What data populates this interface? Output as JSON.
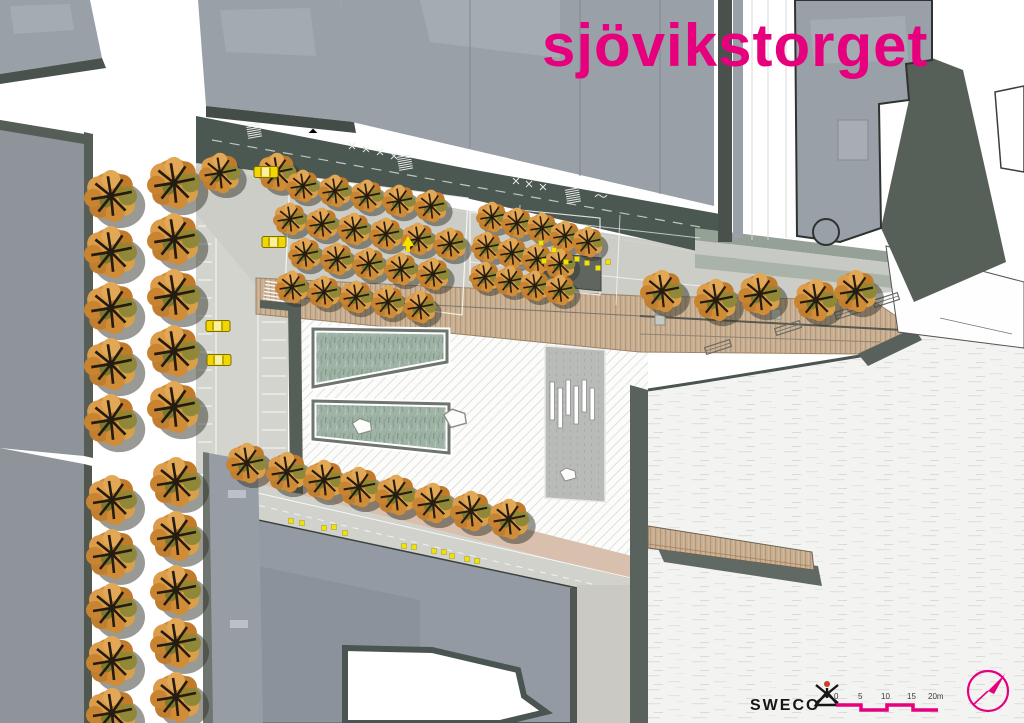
{
  "title": "sjövikstorget",
  "colors": {
    "accent": "#e6007e",
    "building": "#9aa0a8",
    "building_dark_edge": "#4a524c",
    "road_dark": "#4b5751",
    "street_light": "#d4d4ce",
    "wood": "#c8ae91",
    "pool_green": "#9eb2a5",
    "water": "#f3f3f1",
    "tree_orange": "#cf8a3a",
    "car_yellow": "#f2d600"
  },
  "footer": {
    "logo_text": "SWECO",
    "scale_labels": [
      "0",
      "5",
      "10",
      "15",
      "20m"
    ]
  },
  "map": {
    "trees": [
      [
        111,
        196,
        27
      ],
      [
        111,
        252,
        27
      ],
      [
        111,
        308,
        27
      ],
      [
        111,
        364,
        27
      ],
      [
        111,
        420,
        27
      ],
      [
        174,
        183,
        27
      ],
      [
        174,
        239,
        27
      ],
      [
        174,
        295,
        27
      ],
      [
        174,
        351,
        27
      ],
      [
        174,
        407,
        27
      ],
      [
        220,
        173,
        21
      ],
      [
        277,
        172,
        20
      ],
      [
        112,
        500,
        26
      ],
      [
        112,
        554,
        26
      ],
      [
        112,
        608,
        26
      ],
      [
        112,
        661,
        26
      ],
      [
        112,
        713,
        26
      ],
      [
        176,
        482,
        26
      ],
      [
        176,
        536,
        26
      ],
      [
        176,
        590,
        26
      ],
      [
        176,
        643,
        26
      ],
      [
        176,
        697,
        26
      ],
      [
        303,
        186,
        17
      ],
      [
        335,
        191,
        17
      ],
      [
        367,
        196,
        17
      ],
      [
        399,
        201,
        17
      ],
      [
        431,
        206,
        17
      ],
      [
        290,
        219,
        17
      ],
      [
        322,
        224,
        17
      ],
      [
        354,
        229,
        17
      ],
      [
        386,
        234,
        17
      ],
      [
        418,
        239,
        17
      ],
      [
        450,
        244,
        17
      ],
      [
        305,
        254,
        17
      ],
      [
        337,
        259,
        17
      ],
      [
        369,
        264,
        17
      ],
      [
        401,
        269,
        17
      ],
      [
        433,
        274,
        17
      ],
      [
        292,
        287,
        17
      ],
      [
        324,
        292,
        17
      ],
      [
        356,
        297,
        17
      ],
      [
        388,
        302,
        17
      ],
      [
        420,
        307,
        17
      ],
      [
        492,
        217,
        16
      ],
      [
        517,
        223,
        16
      ],
      [
        542,
        228,
        16
      ],
      [
        565,
        236,
        16
      ],
      [
        588,
        242,
        16
      ],
      [
        487,
        247,
        16
      ],
      [
        512,
        253,
        16
      ],
      [
        537,
        259,
        16
      ],
      [
        560,
        264,
        16
      ],
      [
        485,
        277,
        16
      ],
      [
        510,
        281,
        16
      ],
      [
        535,
        286,
        16
      ],
      [
        560,
        290,
        16
      ],
      [
        662,
        291,
        22
      ],
      [
        716,
        300,
        22
      ],
      [
        760,
        294,
        22
      ],
      [
        816,
        300,
        22
      ],
      [
        856,
        291,
        22
      ],
      [
        247,
        463,
        21
      ],
      [
        287,
        472,
        21
      ],
      [
        324,
        480,
        21
      ],
      [
        359,
        487,
        21
      ],
      [
        396,
        495,
        21
      ],
      [
        433,
        503,
        21
      ],
      [
        471,
        511,
        21
      ],
      [
        509,
        519,
        21
      ]
    ],
    "cars": [
      [
        274,
        242,
        0
      ],
      [
        218,
        326,
        0
      ],
      [
        219,
        360,
        0
      ],
      [
        266,
        172,
        0
      ]
    ],
    "pedestrian_dots": [
      [
        541,
        243
      ],
      [
        554,
        250
      ],
      [
        544,
        261
      ],
      [
        566,
        262
      ],
      [
        577,
        259
      ],
      [
        587,
        263
      ],
      [
        598,
        268
      ],
      [
        608,
        262
      ],
      [
        291,
        521
      ],
      [
        302,
        523
      ],
      [
        324,
        528
      ],
      [
        334,
        527
      ],
      [
        345,
        533
      ],
      [
        404,
        546
      ],
      [
        414,
        547
      ],
      [
        434,
        551
      ],
      [
        444,
        552
      ],
      [
        452,
        556
      ],
      [
        467,
        559
      ],
      [
        477,
        561
      ]
    ],
    "benches": [
      [
        718,
        347,
        -18
      ],
      [
        788,
        328,
        -18
      ],
      [
        848,
        312,
        -18
      ],
      [
        886,
        300,
        -18
      ]
    ],
    "planters": [
      [
        660,
        320
      ],
      [
        776,
        314
      ]
    ],
    "stones": [
      [
        362,
        427,
        1.2
      ],
      [
        455,
        419,
        1.4
      ],
      [
        568,
        475,
        1.0
      ]
    ]
  }
}
